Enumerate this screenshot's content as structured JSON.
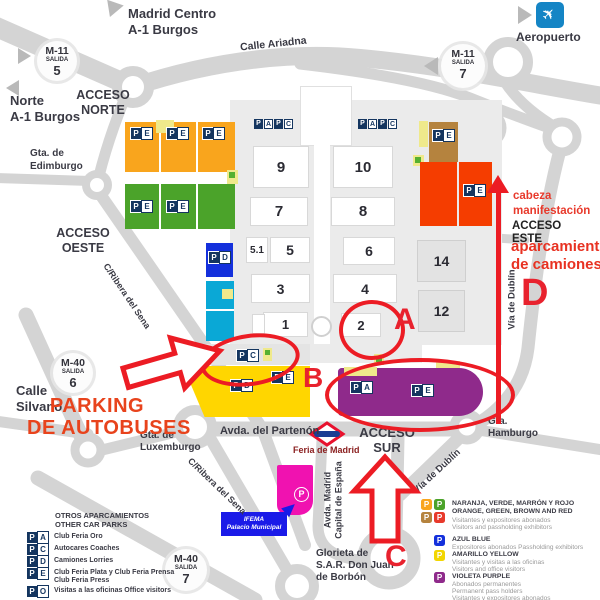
{
  "colors": {
    "road": "#D4D4D4",
    "campus": "#EBEBEB",
    "orange_parking": "#F9A51D",
    "green_parking": "#4BA32A",
    "blue_parking": "#1430DC",
    "cyan_parking": "#0AA8D6",
    "yellow_parking": "#FFD600",
    "purple_parking": "#8F2A8B",
    "magenta_parking": "#F012B0",
    "red_parking": "#F53D00",
    "brown_parking": "#B5833E",
    "pale_yellow": "#EFE98B",
    "badge_navy": "#14355F",
    "annotation_red": "#EC1C24",
    "metro_red": "#E8112D",
    "metro_blue": "#1B3E93",
    "airport_blue": "#1585C5",
    "ifema_blue": "#1A1AE8"
  },
  "badge_letters": {
    "P": "P",
    "A": "A",
    "C": "C",
    "D": "D",
    "E": "E",
    "O": "O"
  },
  "halls": [
    "9",
    "10",
    "7",
    "8",
    "5.1",
    "5",
    "6",
    "3",
    "4",
    "1",
    "2",
    "14",
    "12"
  ],
  "exits": {
    "m11_5": {
      "road": "M-11",
      "salida": "SALIDA",
      "num": "5"
    },
    "m11_7": {
      "road": "M-11",
      "salida": "SALIDA",
      "num": "7"
    },
    "m40_6": {
      "road": "M-40",
      "salida": "SALIDA",
      "num": "6"
    },
    "m40_7": {
      "road": "M-40",
      "salida": "SALIDA",
      "num": "7"
    }
  },
  "access": {
    "norte": {
      "l1": "ACCESO",
      "l2": "NORTE"
    },
    "oeste": {
      "l1": "ACCESO",
      "l2": "OESTE"
    },
    "este": {
      "l1": "ACCESO",
      "l2": "ESTE"
    },
    "sur": {
      "l1": "ACCESO",
      "l2": "SUR"
    }
  },
  "destinations": {
    "madrid_centro": {
      "l1": "Madrid Centro",
      "l2": "A-1 Burgos"
    },
    "norte_burgos": {
      "l1": "Norte",
      "l2": "A-1 Burgos"
    },
    "aeropuerto": "Aeropuerto"
  },
  "streets": {
    "calle_ariadna": "Calle Ariadna",
    "gta_edimburgo": {
      "l1": "Gta. de",
      "l2": "Edimburgo"
    },
    "ribera_sena_1": "C/Ribera del Sena",
    "ribera_sena_2": "C/Ribera del Sena",
    "calle_silvano": {
      "l1": "Calle",
      "l2": "Silvano"
    },
    "gta_luxemburgo": {
      "l1": "Gta. de",
      "l2": "Luxemburgo"
    },
    "avda_partenon": "Avda. del Partenón",
    "avda_madrid": {
      "l1": "Avda. Madrid",
      "l2": "Capital de España"
    },
    "glorieta_sar": {
      "l1": "Glorieta de",
      "l2": "S.A.R. Don Juan",
      "l3": "de Borbón"
    },
    "gta_hamburgo": {
      "l1": "Gta.",
      "l2": "Hamburgo"
    },
    "via_dublin_east": "Vía de Dublín",
    "via_dublin_south": "Vía de Dublín"
  },
  "metro": {
    "station": "Feria de Madrid"
  },
  "ifema_building": {
    "l1": "IFEMA",
    "l2": "Palacio Municipal"
  },
  "red_annotations": {
    "a": "A",
    "b": "B",
    "c": "C",
    "d": "D",
    "cabeza": {
      "l1": "cabeza",
      "l2": "manifestación"
    },
    "camiones": {
      "l1": "aparcamiento",
      "l2": "de camiones"
    },
    "autobuses": {
      "l1": "PARKING",
      "l2": "DE AUTOBUSES"
    }
  },
  "legend_left": {
    "title1": "OTROS APARCAMIENTOS",
    "title2": "OTHER CAR PARKS",
    "rows": [
      {
        "letter": "A",
        "line1": "Club Feria Oro"
      },
      {
        "letter": "C",
        "line1": "Autocares  Coaches"
      },
      {
        "letter": "D",
        "line1": "Camiones  Lorries"
      },
      {
        "letter": "E",
        "line1": "Club Feria Plata y Club Feria Prensa",
        "line2": "Club Feria Press"
      },
      {
        "letter": "O",
        "line1": "Visitas a las oficinas  Office visitors"
      }
    ]
  },
  "legend_right": {
    "rows": [
      {
        "title1": "NARANJA, VERDE, MARRÓN Y ROJO",
        "title2": "ORANGE, GREEN, BROWN AND RED",
        "sub1": "Visitantes y expositores abonados",
        "sub2": "Visitors and passholding exhibitors"
      },
      {
        "title1": "AZUL  BLUE",
        "sub1": "Expositores abonados  Passholding exhibitors"
      },
      {
        "title1": "AMARILLO  YELLOW",
        "sub1": "Visitantes y visitas a las oficinas",
        "sub2": "Visitors and office visitors"
      },
      {
        "title1": "VIOLETA  PURPLE",
        "sub1": "Abonados permanentes",
        "sub2": "Permanent pass holders",
        "sub3": "Visitantes y expositores abonados",
        "sub4": "Visitors and passholding exhibitors"
      }
    ]
  }
}
